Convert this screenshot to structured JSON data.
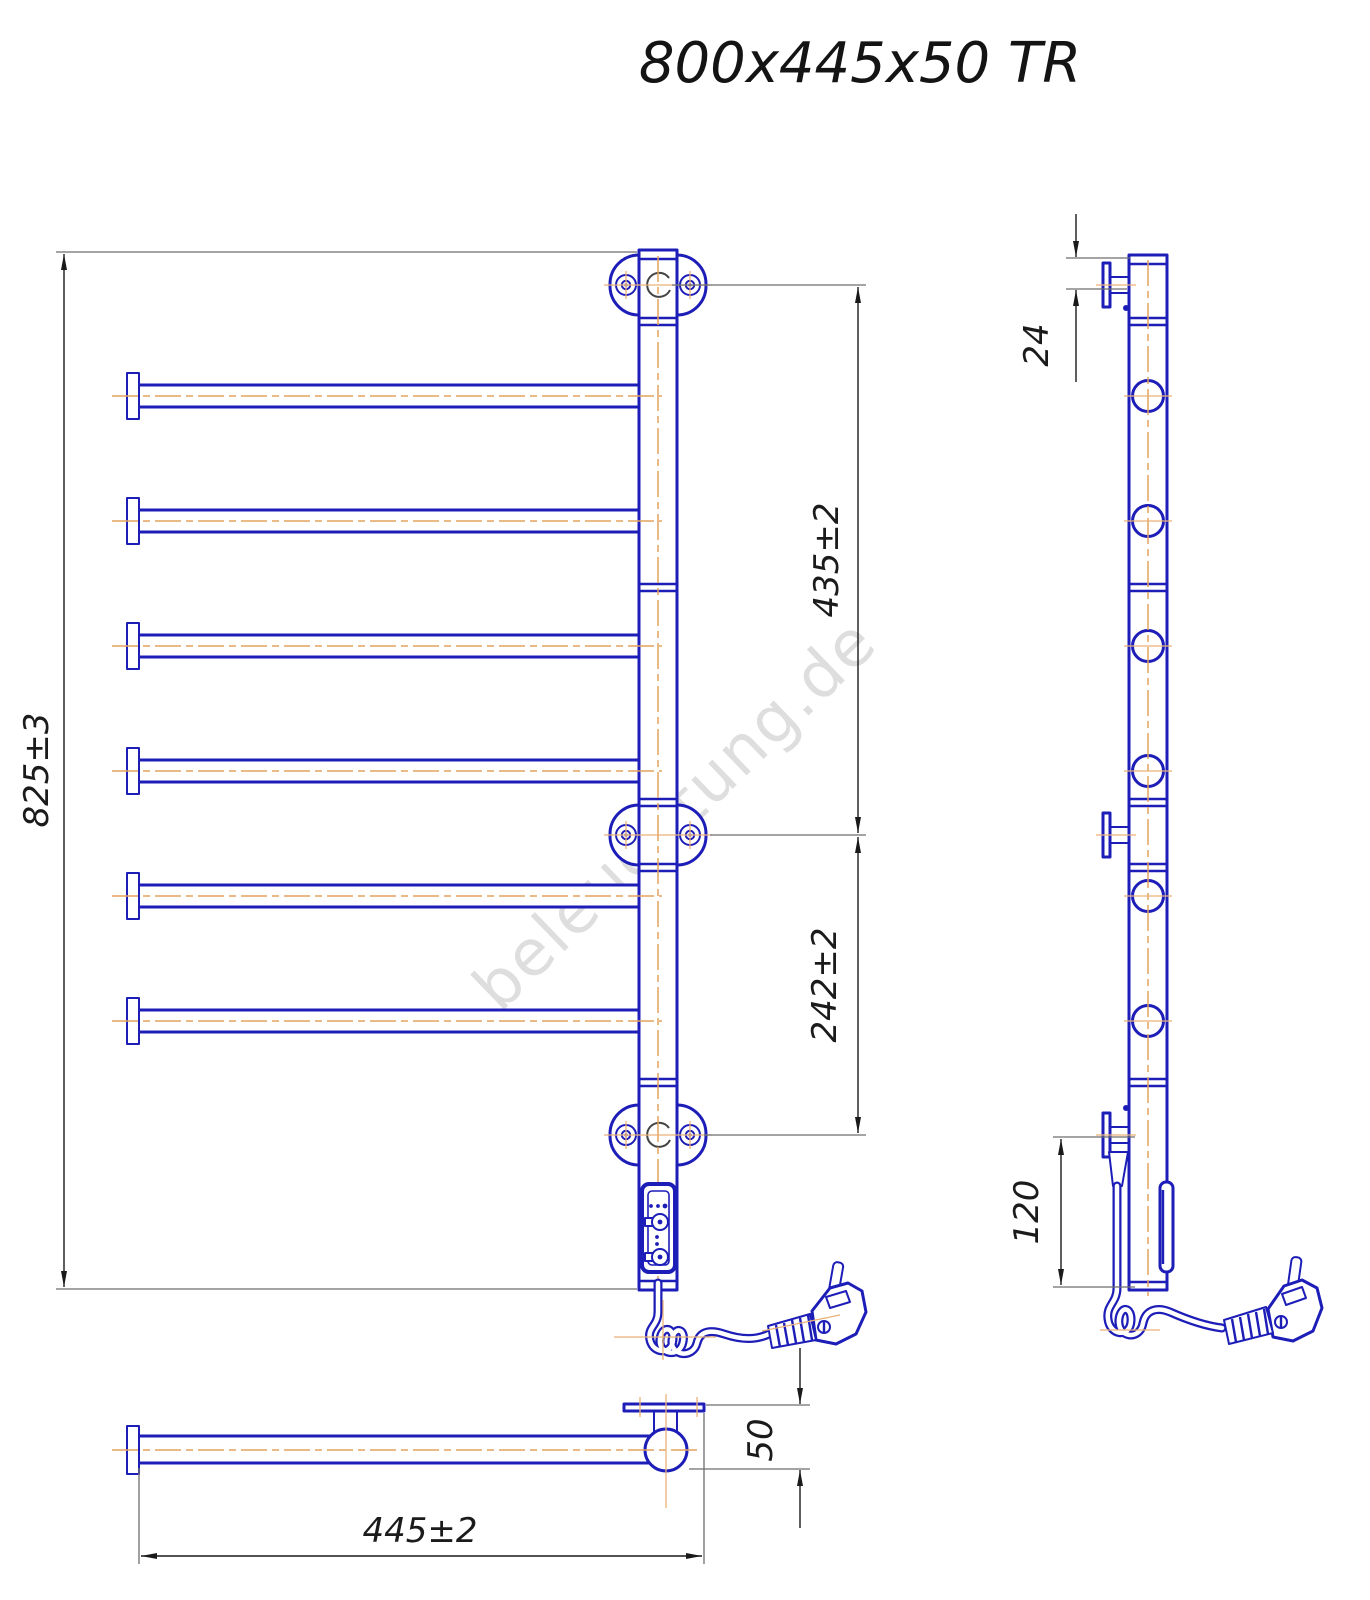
{
  "title": "800x445x50 TR",
  "watermark": "beleuchtung.de",
  "drawing": {
    "product": "heated towel rail, 6 bars, technical drawing with three views",
    "bar_count": 6,
    "dimensions": {
      "overall_height": "825±3",
      "upper_section": "435±2",
      "lower_section": "242±2",
      "top_bracket_offset": "24",
      "bottom_bracket_offset": "120",
      "overall_width": "445±2",
      "depth": "50"
    },
    "colors": {
      "outline": "#1d1db8",
      "centerline": "#e2a25e",
      "dimension_line": "#6e6e6e",
      "text": "#1b1b1b",
      "watermark": "#c4c4c4"
    }
  }
}
